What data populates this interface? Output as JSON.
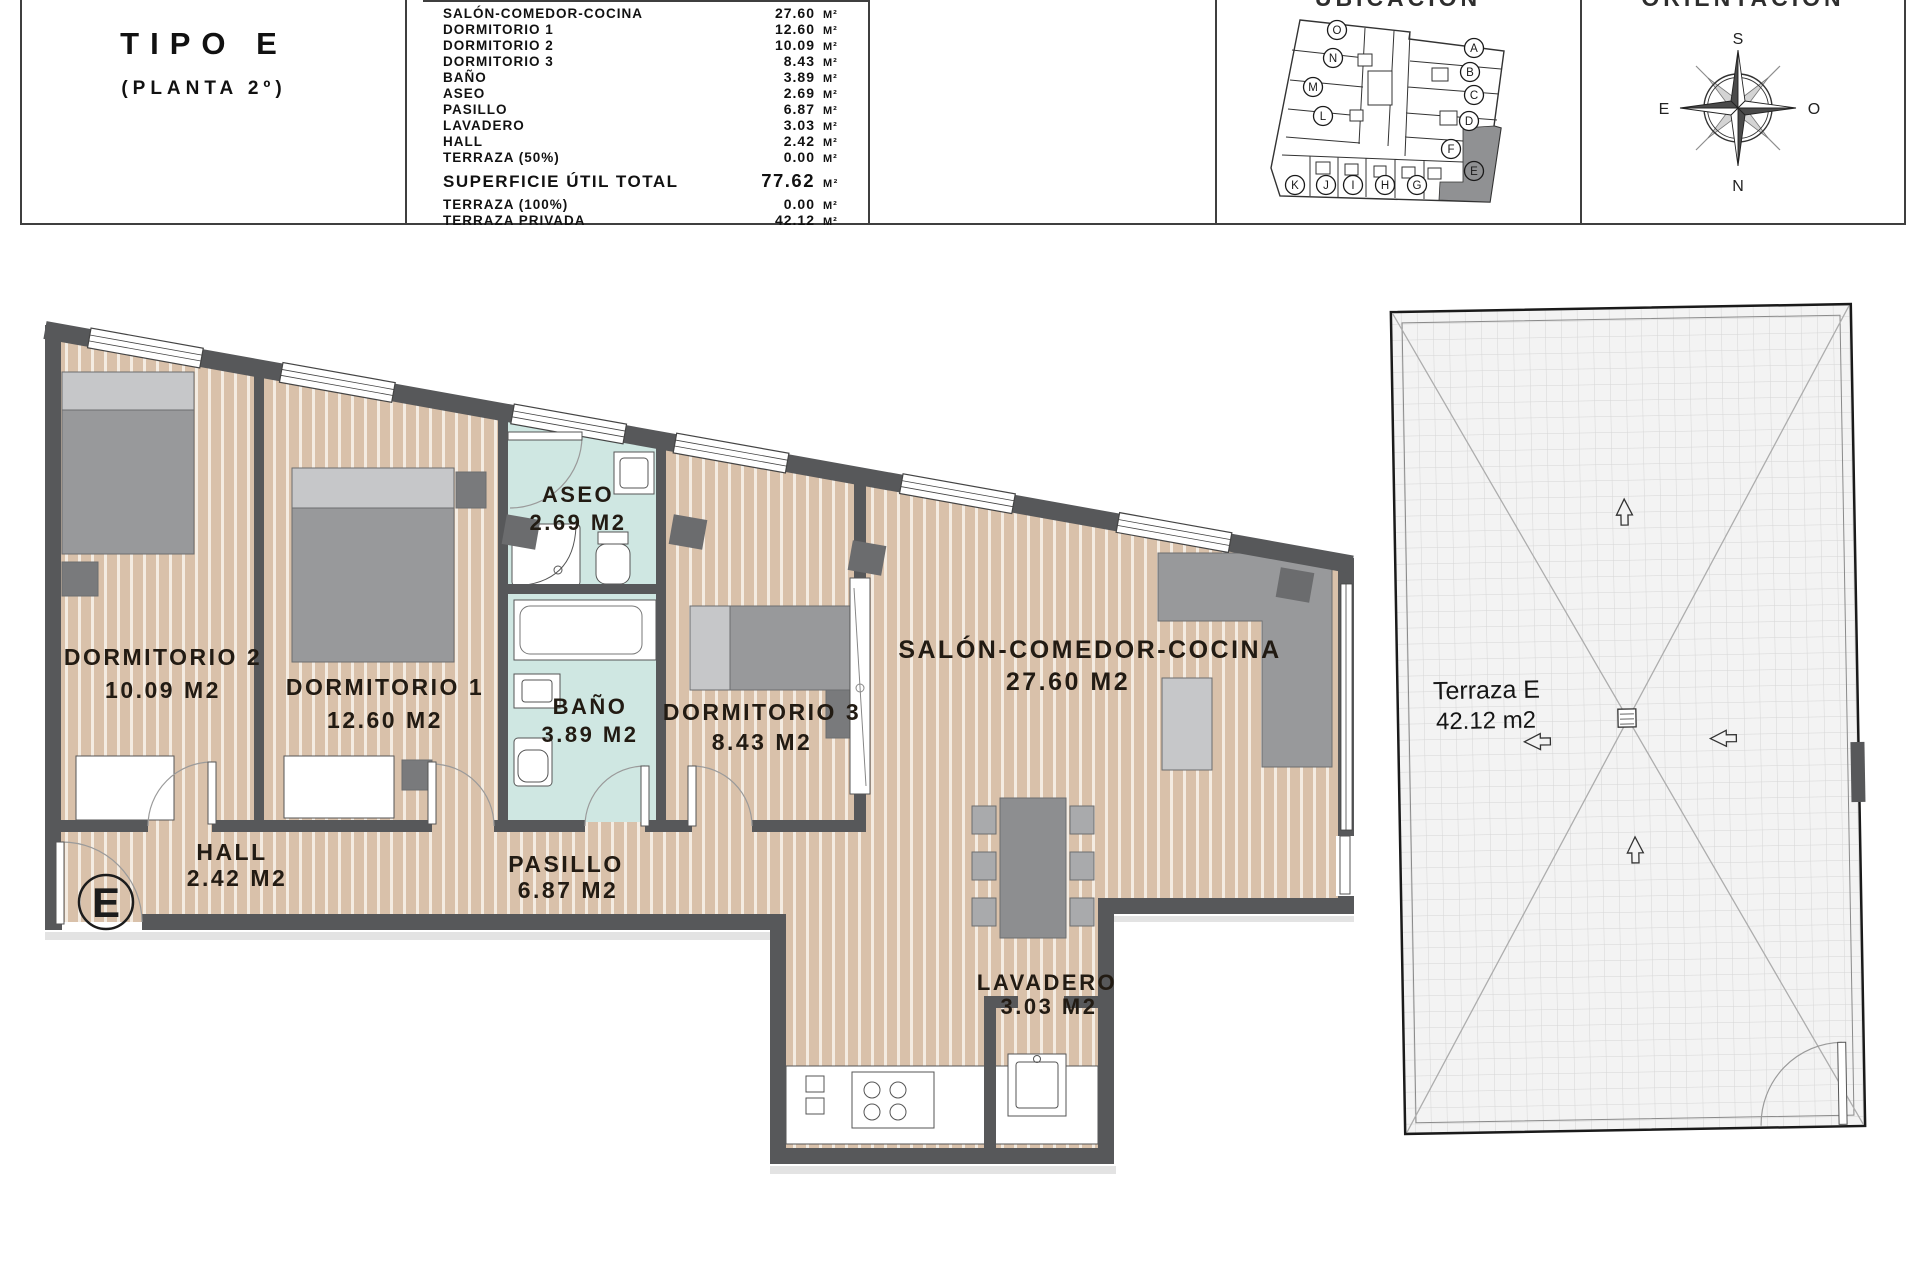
{
  "header": {
    "unit_type": "TIPO E",
    "floor": "(PLANTA 2º)",
    "areas": {
      "unit": "M²",
      "rows": [
        {
          "label": "SALÓN-COMEDOR-COCINA",
          "value": "27.60"
        },
        {
          "label": "DORMITORIO 1",
          "value": "12.60"
        },
        {
          "label": "DORMITORIO 2",
          "value": "10.09"
        },
        {
          "label": "DORMITORIO 3",
          "value": "8.43"
        },
        {
          "label": "BAÑO",
          "value": "3.89"
        },
        {
          "label": "ASEO",
          "value": "2.69"
        },
        {
          "label": "PASILLO",
          "value": "6.87"
        },
        {
          "label": "LAVADERO",
          "value": "3.03"
        },
        {
          "label": "HALL",
          "value": "2.42"
        },
        {
          "label": "TERRAZA (50%)",
          "value": "0.00"
        }
      ],
      "total": {
        "label": "SUPERFICIE ÚTIL TOTAL",
        "value": "77.62"
      },
      "extras": [
        {
          "label": "TERRAZA (100%)",
          "value": "0.00"
        },
        {
          "label": "TERRAZA PRIVADA",
          "value": "42.12"
        }
      ]
    },
    "ubicacion": {
      "title": "UBICACIÓN",
      "highlighted_unit": "E",
      "units": [
        "O",
        "N",
        "M",
        "L",
        "A",
        "B",
        "C",
        "D",
        "F",
        "E",
        "K",
        "J",
        "I",
        "H",
        "G"
      ]
    },
    "orientacion": {
      "title": "ORIENTACIÓN",
      "compass": {
        "top": "S",
        "right": "O",
        "bottom": "N",
        "left": "E"
      }
    }
  },
  "plan": {
    "rooms": [
      {
        "name": "DORMITORIO 2",
        "area": "10.09 M2"
      },
      {
        "name": "DORMITORIO 1",
        "area": "12.60 M2"
      },
      {
        "name": "ASEO",
        "area": "2.69 M2"
      },
      {
        "name": "BAÑO",
        "area": "3.89 M2"
      },
      {
        "name": "DORMITORIO 3",
        "area": "8.43 M2"
      },
      {
        "name": "SALÓN-COMEDOR-COCINA",
        "area": "27.60 M2"
      },
      {
        "name": "HALL",
        "area": "2.42 M2"
      },
      {
        "name": "PASILLO",
        "area": "6.87 M2"
      },
      {
        "name": "LAVADERO",
        "area": "3.03 M2"
      }
    ],
    "terrace": {
      "name": "Terraza E",
      "area": "42.12 m2"
    },
    "entrance_mark": "E"
  },
  "colors": {
    "wall": "#57585a",
    "floor": "#d9c1aa",
    "floor_stripe": "#f4ece2",
    "wet_floor": "#cfe7e2",
    "furniture": "#98999b",
    "furniture_dark": "#797a7c",
    "furniture_light": "#c6c7c9",
    "terrace_bg": "#f3f3f3",
    "highlight_unit": "#909193"
  }
}
